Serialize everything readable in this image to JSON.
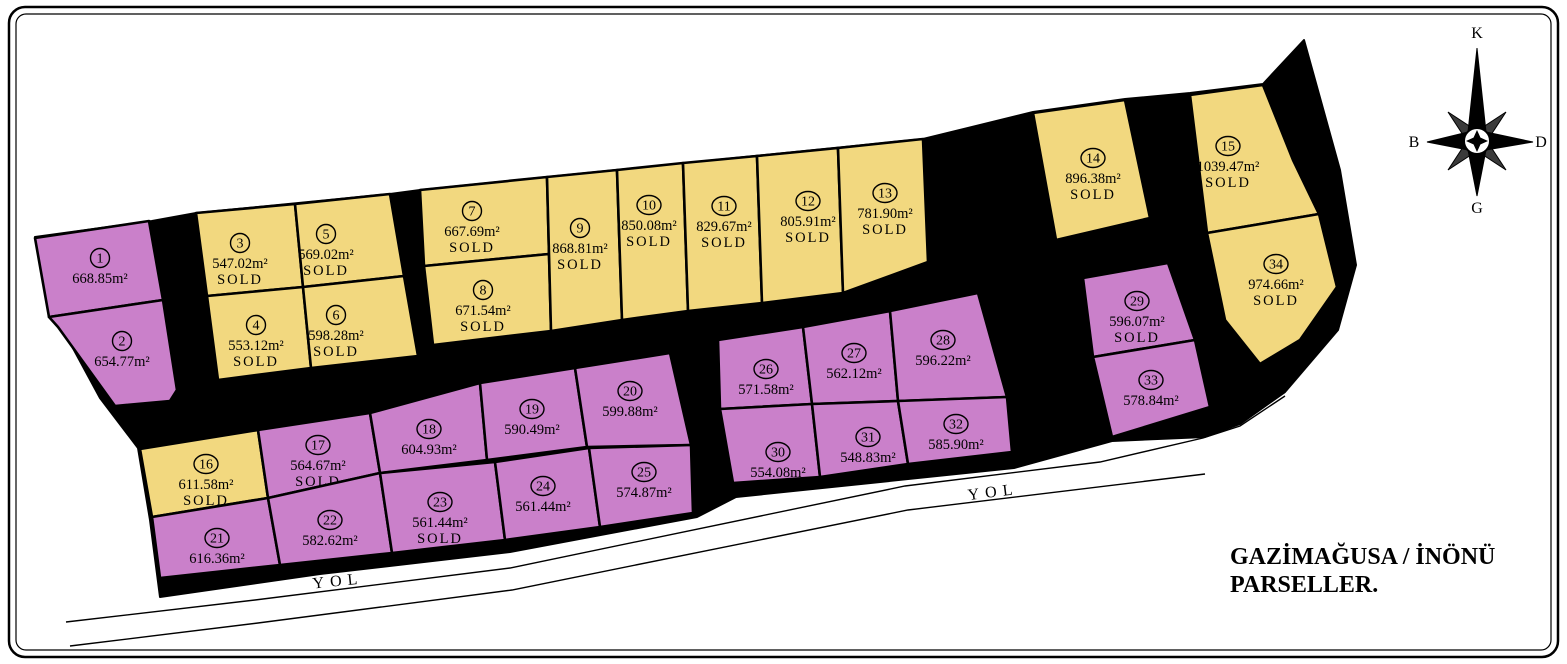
{
  "title": {
    "line1": "GAZİMAĞUSA / İNÖNÜ",
    "line2": "PARSELLER."
  },
  "road_label": "YOL",
  "sold_label": "SOLD",
  "compass": {
    "north": "K",
    "east": "D",
    "south": "G",
    "west": "B"
  },
  "colors": {
    "yellow": "#F2D87F",
    "purple": "#CA80CA",
    "road": "#000000"
  },
  "parcels": [
    {
      "number": "1",
      "area": "668.85m²",
      "sold": false,
      "color": "purple",
      "cx": 100,
      "cy": 258,
      "points": "35,238 149,221 163,300 49,317"
    },
    {
      "number": "2",
      "area": "654.77m²",
      "sold": false,
      "color": "purple",
      "cx": 122,
      "cy": 341,
      "points": "49,317 163,300 177,390 170,401 115,406 58,327"
    },
    {
      "number": "3",
      "area": "547.02m²",
      "sold": true,
      "color": "yellow",
      "cx": 240,
      "cy": 243,
      "points": "196,213 295,204 303,287 207,296"
    },
    {
      "number": "4",
      "area": "553.12m²",
      "sold": true,
      "color": "yellow",
      "cx": 256,
      "cy": 325,
      "points": "207,296 303,287 311,368 218,380"
    },
    {
      "number": "5",
      "area": "569.02m²",
      "sold": true,
      "color": "yellow",
      "cx": 326,
      "cy": 234,
      "points": "295,204 390,194 404,276 303,287"
    },
    {
      "number": "6",
      "area": "598.28m²",
      "sold": true,
      "color": "yellow",
      "cx": 336,
      "cy": 315,
      "points": "303,287 404,276 418,356 311,368"
    },
    {
      "number": "7",
      "area": "667.69m²",
      "sold": true,
      "color": "yellow",
      "cx": 472,
      "cy": 211,
      "points": "420,190 547,177 549,254 424,266"
    },
    {
      "number": "8",
      "area": "671.54m²",
      "sold": true,
      "color": "yellow",
      "cx": 483,
      "cy": 290,
      "points": "424,266 549,254 551,331 433,345"
    },
    {
      "number": "9",
      "area": "868.81m²",
      "sold": true,
      "color": "yellow",
      "cx": 580,
      "cy": 228,
      "points": "547,177 617,170 622,320 551,331"
    },
    {
      "number": "10",
      "area": "850.08m²",
      "sold": true,
      "color": "yellow",
      "cx": 649,
      "cy": 205,
      "points": "617,170 683,163 688,311 622,320"
    },
    {
      "number": "11",
      "area": "829.67m²",
      "sold": true,
      "color": "yellow",
      "cx": 724,
      "cy": 206,
      "points": "683,163 757,156 762,303 688,311"
    },
    {
      "number": "12",
      "area": "805.91m²",
      "sold": true,
      "color": "yellow",
      "cx": 808,
      "cy": 201,
      "points": "757,156 838,148 843,293 762,303"
    },
    {
      "number": "13",
      "area": "781.90m²",
      "sold": true,
      "color": "yellow",
      "cx": 885,
      "cy": 193,
      "points": "838,148 923,139 928,262 843,293"
    },
    {
      "number": "14",
      "area": "896.38m²",
      "sold": true,
      "color": "yellow",
      "cx": 1093,
      "cy": 158,
      "points": "1033,113 1125,100 1150,218 1056,240"
    },
    {
      "number": "15",
      "area": "1039.47m²",
      "sold": true,
      "color": "yellow",
      "cx": 1228,
      "cy": 146,
      "points": "1190,95 1263,85 1293,160 1319,214 1207,233"
    },
    {
      "number": "16",
      "area": "611.58m²",
      "sold": true,
      "color": "yellow",
      "cx": 206,
      "cy": 464,
      "points": "140,449 258,430 268,498 152,517"
    },
    {
      "number": "17",
      "area": "564.67m²",
      "sold": true,
      "color": "purple",
      "cx": 318,
      "cy": 445,
      "points": "258,430 370,413 380,473 268,498"
    },
    {
      "number": "18",
      "area": "604.93m²",
      "sold": false,
      "color": "purple",
      "cx": 429,
      "cy": 429,
      "points": "370,413 480,383 487,460 380,473"
    },
    {
      "number": "19",
      "area": "590.49m²",
      "sold": false,
      "color": "purple",
      "cx": 532,
      "cy": 409,
      "points": "480,383 575,368 587,447 487,460"
    },
    {
      "number": "20",
      "area": "599.88m²",
      "sold": false,
      "color": "purple",
      "cx": 630,
      "cy": 391,
      "points": "575,368 670,353 691,445 587,447"
    },
    {
      "number": "21",
      "area": "616.36m²",
      "sold": false,
      "color": "purple",
      "cx": 217,
      "cy": 538,
      "points": "152,517 268,498 280,565 160,578"
    },
    {
      "number": "22",
      "area": "582.62m²",
      "sold": false,
      "color": "purple",
      "cx": 330,
      "cy": 520,
      "points": "268,498 380,473 392,553 280,565"
    },
    {
      "number": "23",
      "area": "561.44m²",
      "sold": true,
      "color": "purple",
      "cx": 440,
      "cy": 502,
      "points": "380,473 495,462 505,540 392,553"
    },
    {
      "number": "24",
      "area": "561.44m²",
      "sold": false,
      "color": "purple",
      "cx": 543,
      "cy": 486,
      "points": "495,462 589,448 600,527 505,540"
    },
    {
      "number": "25",
      "area": "574.87m²",
      "sold": false,
      "color": "purple",
      "cx": 644,
      "cy": 472,
      "points": "589,448 691,445 693,513 600,527"
    },
    {
      "number": "26",
      "area": "571.58m²",
      "sold": false,
      "color": "purple",
      "cx": 766,
      "cy": 369,
      "points": "718,340 803,327 812,404 720,409"
    },
    {
      "number": "27",
      "area": "562.12m²",
      "sold": false,
      "color": "purple",
      "cx": 854,
      "cy": 353,
      "points": "803,327 890,311 898,401 812,404"
    },
    {
      "number": "28",
      "area": "596.22m²",
      "sold": false,
      "color": "purple",
      "cx": 943,
      "cy": 340,
      "points": "890,311 978,293 1007,397 898,401"
    },
    {
      "number": "29",
      "area": "596.07m²",
      "sold": true,
      "color": "purple",
      "cx": 1137,
      "cy": 301,
      "points": "1083,278 1168,263 1195,340 1093,357"
    },
    {
      "number": "30",
      "area": "554.08m²",
      "sold": false,
      "color": "purple",
      "cx": 778,
      "cy": 452,
      "points": "720,409 812,404 820,477 733,483"
    },
    {
      "number": "31",
      "area": "548.83m²",
      "sold": false,
      "color": "purple",
      "cx": 868,
      "cy": 437,
      "points": "812,404 898,401 908,464 820,477"
    },
    {
      "number": "32",
      "area": "585.90m²",
      "sold": false,
      "color": "purple",
      "cx": 956,
      "cy": 424,
      "points": "898,401 1007,397 1012,452 908,464"
    },
    {
      "number": "33",
      "area": "578.84m²",
      "sold": false,
      "color": "purple",
      "cx": 1151,
      "cy": 380,
      "points": "1093,357 1195,340 1210,407 1112,437"
    },
    {
      "number": "34",
      "area": "974.66m²",
      "sold": true,
      "color": "yellow",
      "cx": 1276,
      "cy": 264,
      "points": "1207,233 1319,214 1337,287 1300,340 1260,364 1225,320"
    }
  ]
}
